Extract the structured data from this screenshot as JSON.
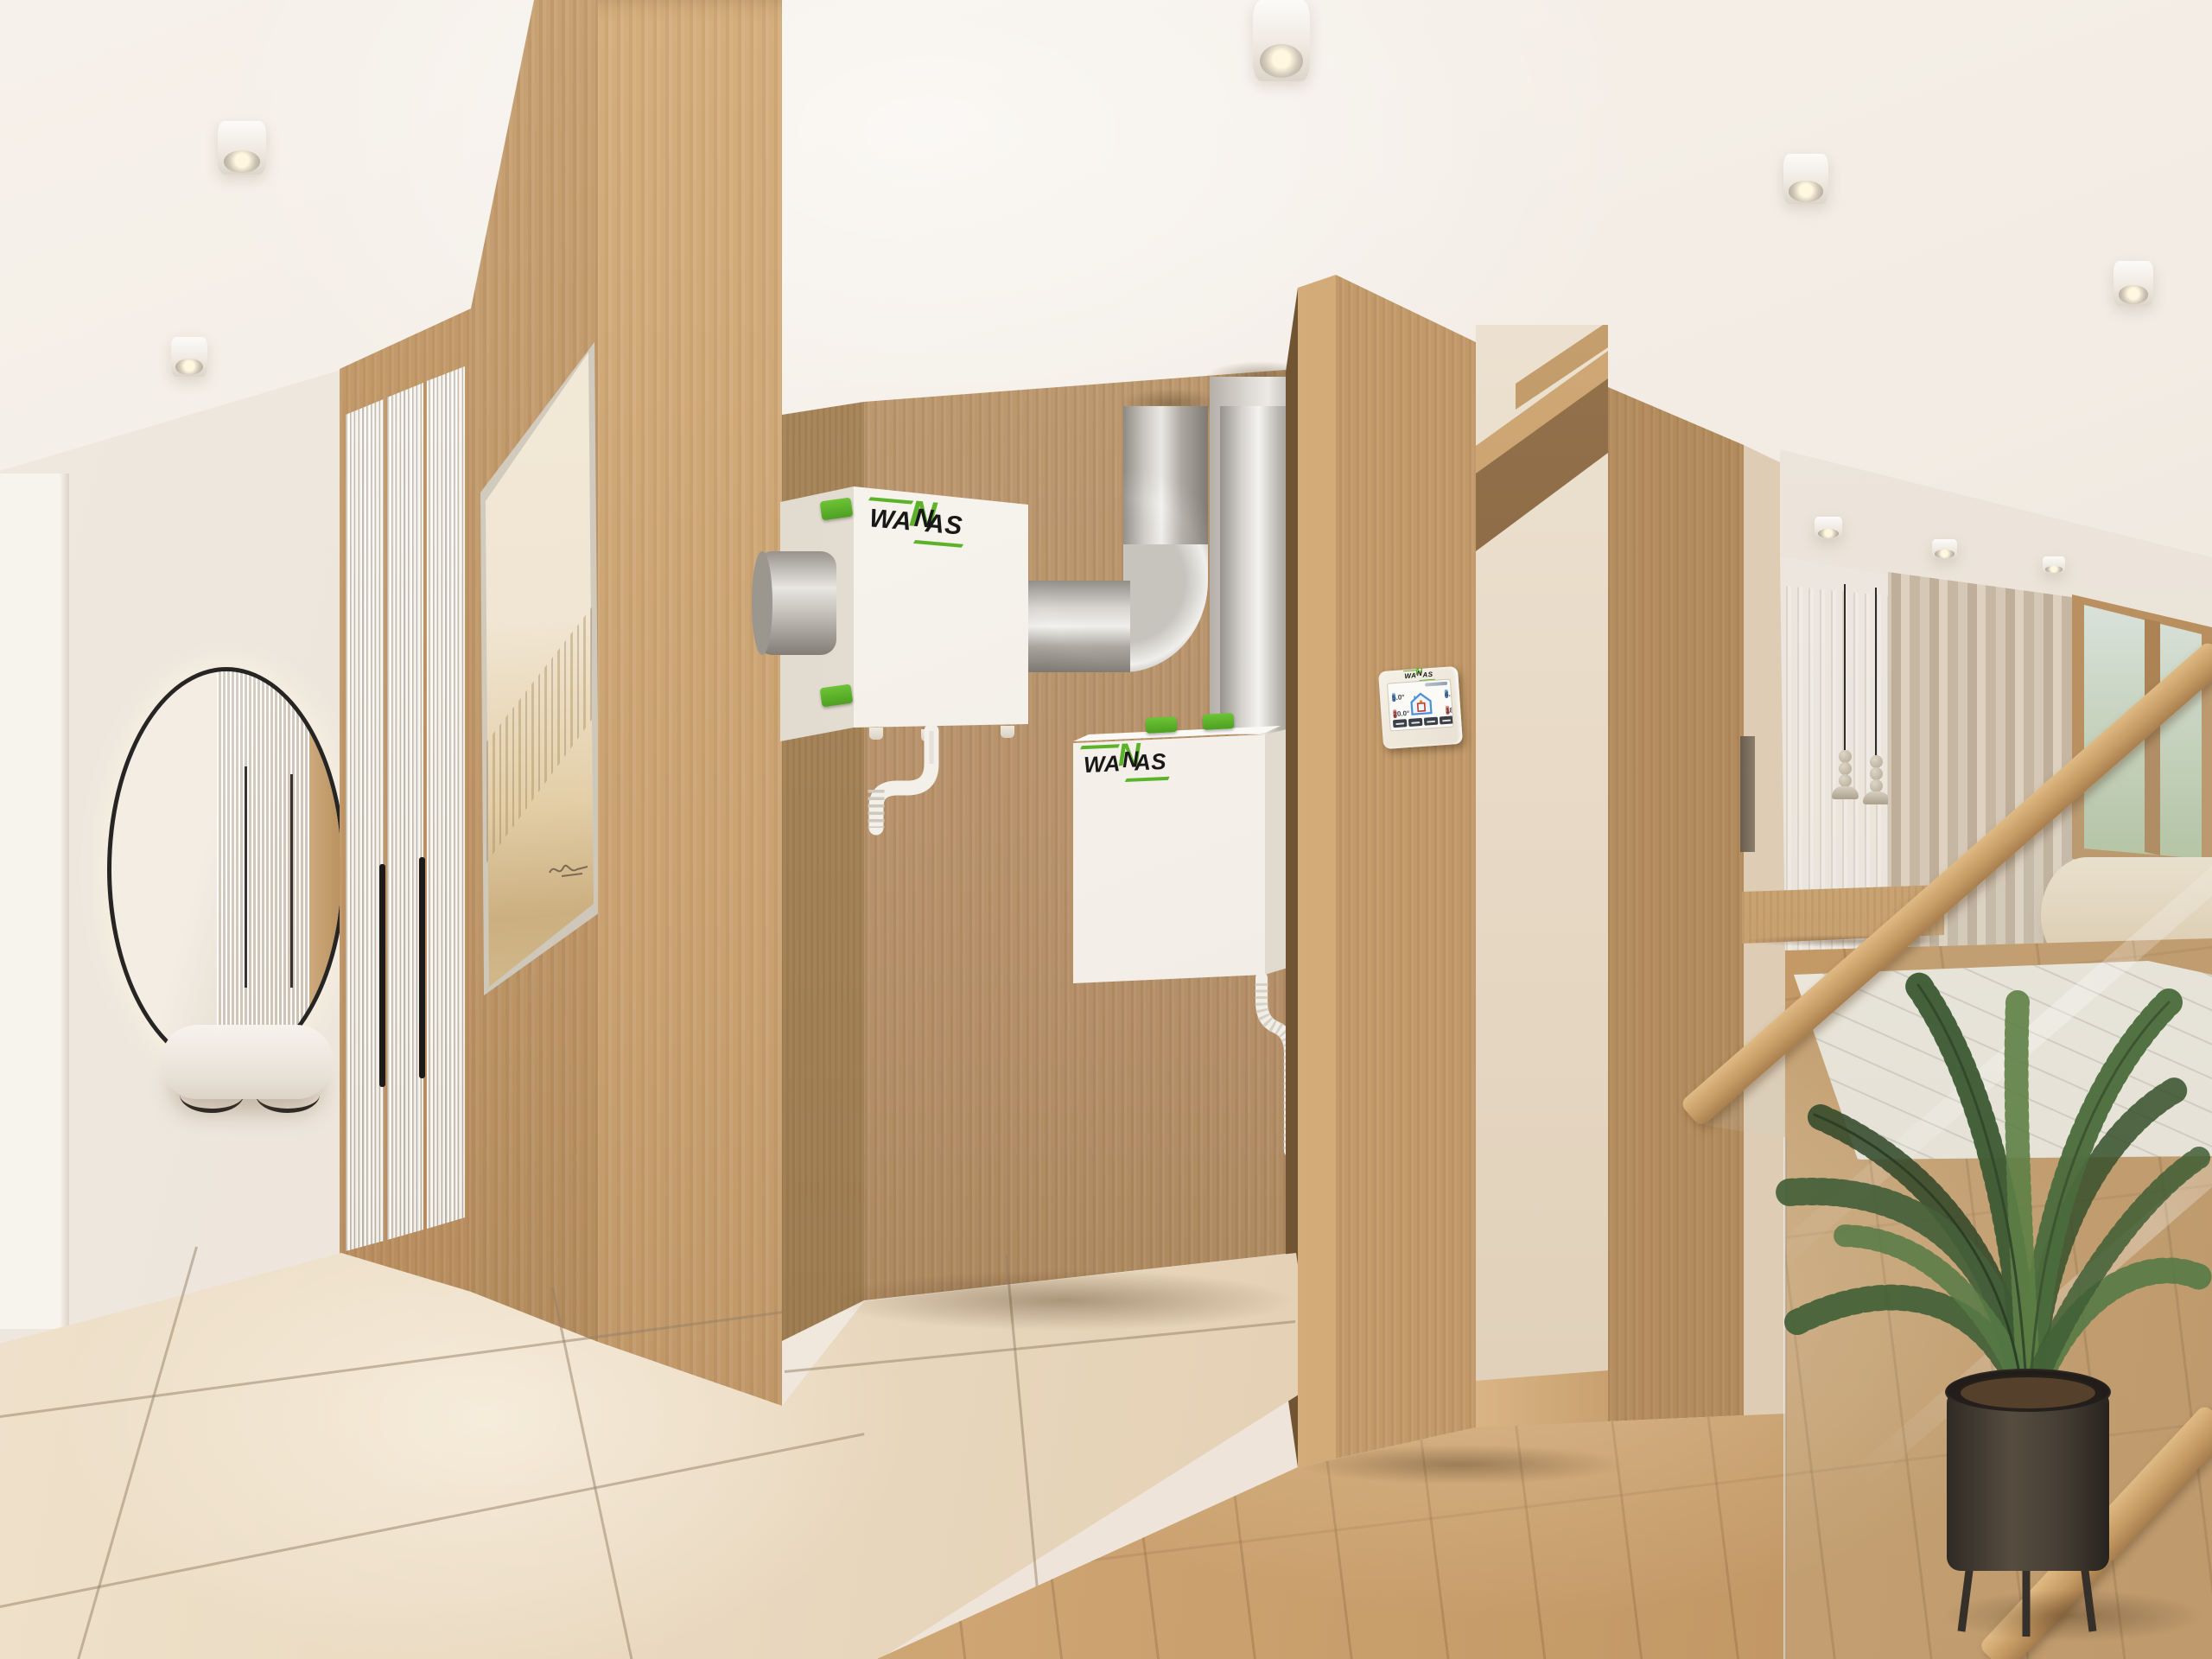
{
  "brand": {
    "name": "WANAS",
    "logo_wa": "WA",
    "logo_n": "N",
    "logo_as": "AS"
  },
  "control_panel": {
    "readings": {
      "left_top": "5.0°",
      "left_bottom": "20.0°",
      "right_top": "4.0°",
      "right_bottom": "18.0°"
    }
  },
  "palette": {
    "accent_green": "#5cb32a",
    "oak_wood": "#c8a070",
    "floor_wood": "#d2ab79",
    "tile_beige": "#e9d8bf",
    "wall_cream": "#ece4da",
    "ceiling_white": "#f4efe8",
    "duct_silver": "#cfccc7",
    "unit_white": "#f6f2ec"
  }
}
